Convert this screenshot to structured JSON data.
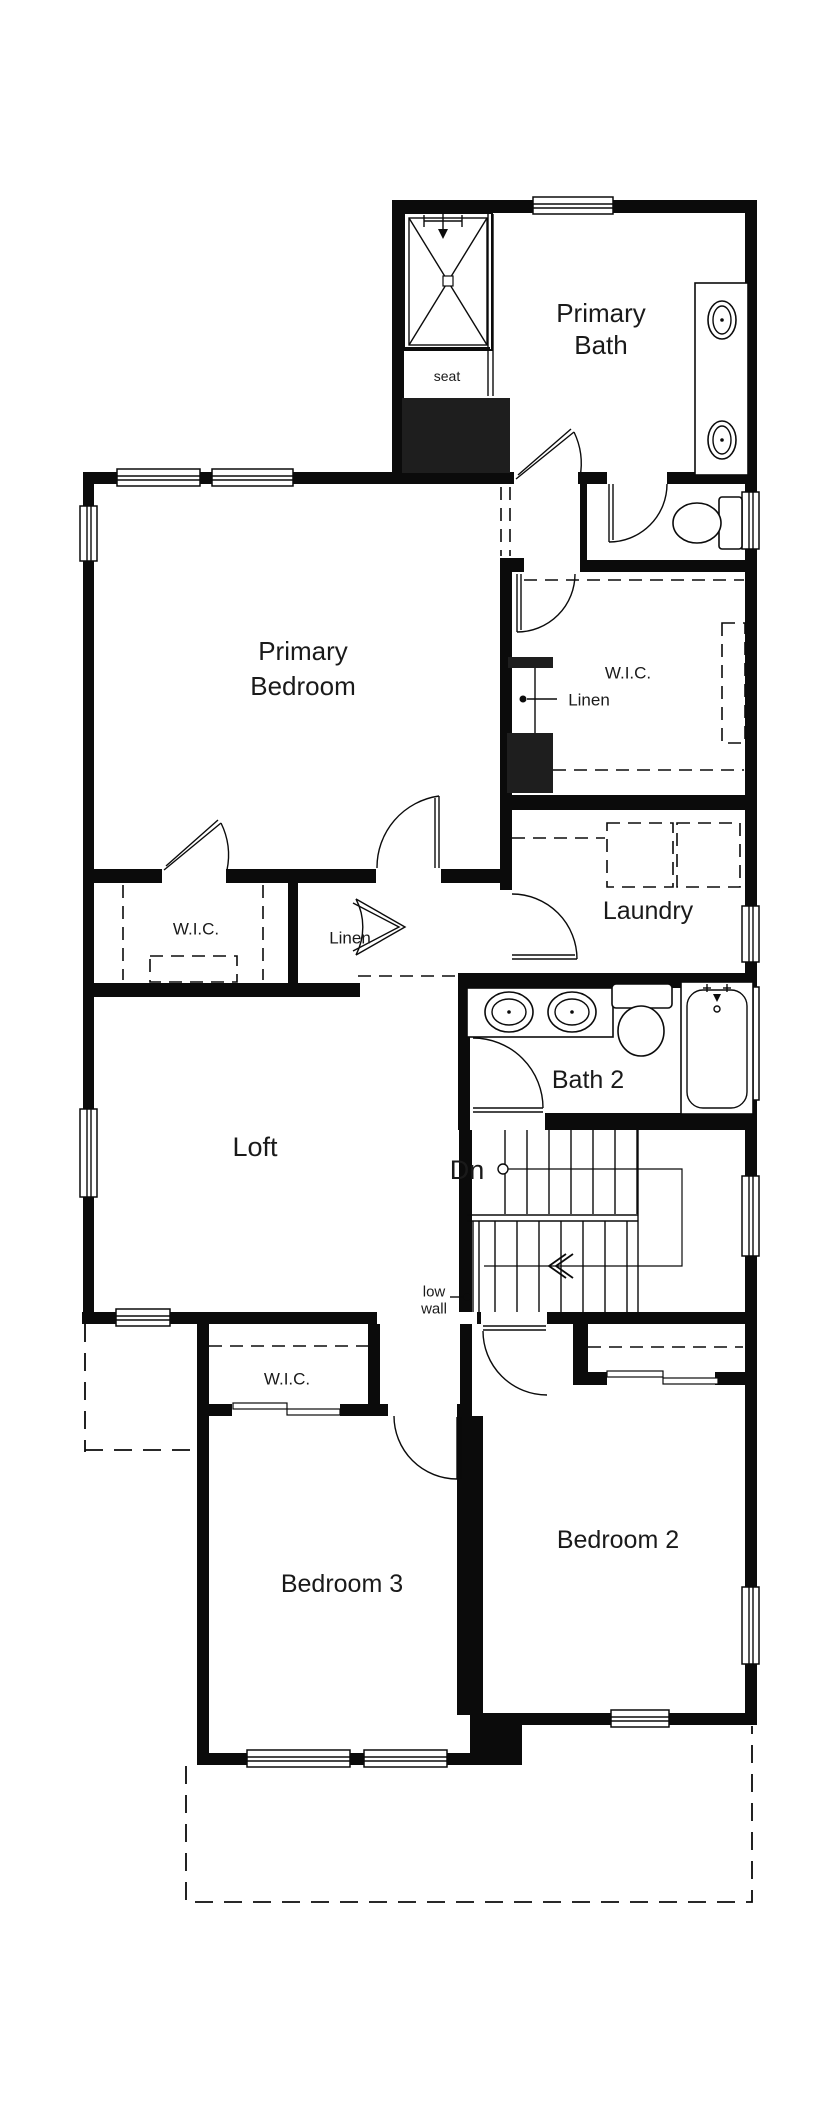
{
  "plan": {
    "rooms": {
      "primary_bath": {
        "label_line1": "Primary",
        "label_line2": "Bath"
      },
      "primary_bedroom": {
        "label_line1": "Primary",
        "label_line2": "Bedroom"
      },
      "wic_bath": {
        "label": "W.I.C."
      },
      "linen_bath": {
        "label": "Linen"
      },
      "laundry": {
        "label": "Laundry"
      },
      "wic_primary": {
        "label": "W.I.C."
      },
      "linen_hall": {
        "label": "Linen"
      },
      "loft": {
        "label": "Loft"
      },
      "bath2": {
        "label": "Bath 2"
      },
      "bedroom2": {
        "label": "Bedroom 2"
      },
      "bedroom3": {
        "label": "Bedroom 3"
      },
      "wic_bedroom3": {
        "label": "W.I.C."
      }
    },
    "annotations": {
      "seat": "seat",
      "stairs_down": "Dn",
      "low_wall_line1": "low",
      "low_wall_line2": "wall"
    },
    "colors": {
      "wall": "#0b0b0b",
      "background": "#ffffff",
      "text": "#1a1a1a"
    }
  }
}
